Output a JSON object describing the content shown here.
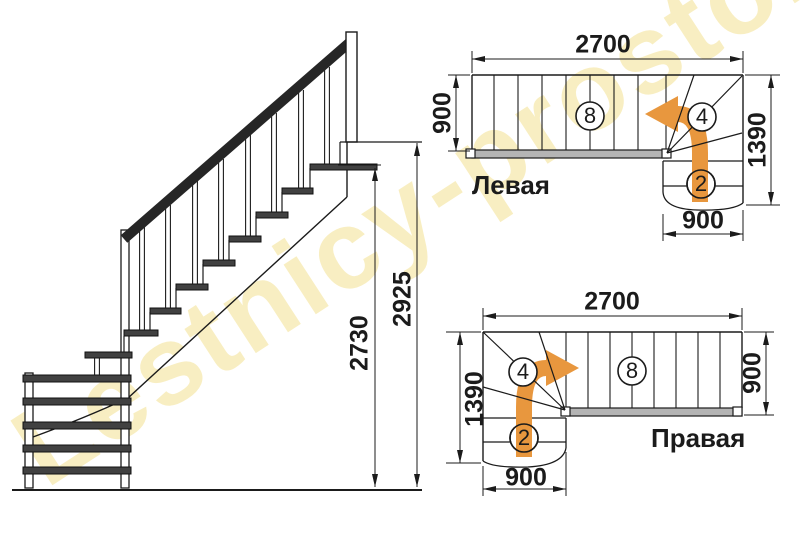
{
  "watermark": {
    "text": "Lestnicy-prosto.ru",
    "color": "#f3df86"
  },
  "elevation": {
    "dims": {
      "inner": "2730",
      "outer": "2925"
    }
  },
  "plans": {
    "left": {
      "label": "Левая",
      "dims": {
        "top": "2700",
        "left": "900",
        "right": "1390",
        "bottom": "900"
      },
      "steps": {
        "main": "8",
        "winder": "4",
        "bottom": "2"
      }
    },
    "right": {
      "label": "Правая",
      "dims": {
        "top": "2700",
        "left": "1390",
        "right": "900",
        "bottom": "900"
      },
      "steps": {
        "main": "8",
        "winder": "4",
        "bottom": "2"
      }
    }
  },
  "colors": {
    "arrow": "#e8973e",
    "stringer": "#b4b4b4"
  }
}
